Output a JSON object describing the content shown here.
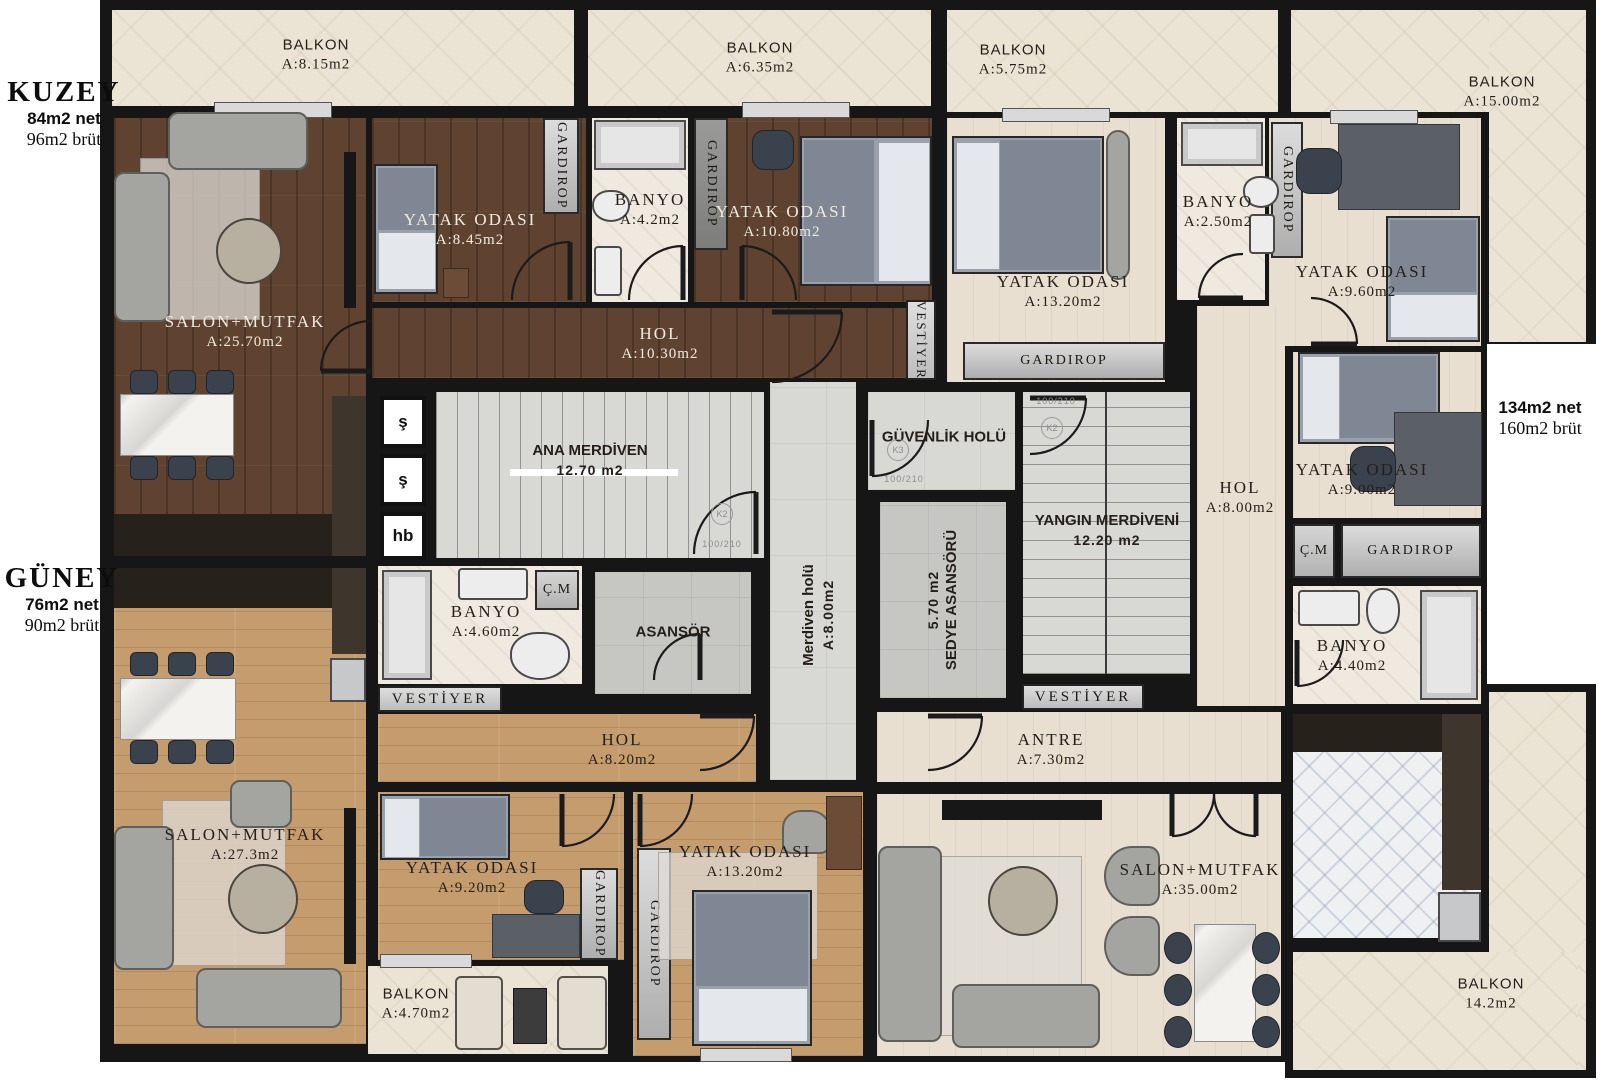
{
  "apartments": {
    "kuzey": {
      "title": "KUZEY",
      "net": "84m2 net",
      "brut": "96m2 brüt"
    },
    "guney": {
      "title": "GÜNEY",
      "net": "76m2 net",
      "brut": "90m2 brüt"
    },
    "daire3": {
      "net": "134m2 net",
      "brut": "160m2 brüt"
    }
  },
  "rooms": {
    "balkon815": {
      "name": "BALKON",
      "area": "A:8.15m2"
    },
    "balkon635": {
      "name": "BALKON",
      "area": "A:6.35m2"
    },
    "balkon575": {
      "name": "BALKON",
      "area": "A:5.75m2"
    },
    "balkon1500": {
      "name": "BALKON",
      "area": "A:15.00m2"
    },
    "balkon470": {
      "name": "BALKON",
      "area": "A:4.70m2"
    },
    "balkon142": {
      "name": "BALKON",
      "area": "14.2m2"
    },
    "kz_salon": {
      "name": "SALON+MUTFAK",
      "area": "A:25.70m2"
    },
    "kz_yatak1": {
      "name": "YATAK ODASI",
      "area": "A:8.45m2"
    },
    "kz_banyo": {
      "name": "BANYO",
      "area": "A:4.2m2"
    },
    "kz_yatak2": {
      "name": "YATAK ODASI",
      "area": "A:10.80m2"
    },
    "kz_hol": {
      "name": "HOL",
      "area": "A:10.30m2"
    },
    "rt_yatak1": {
      "name": "YATAK ODASI",
      "area": "A:13.20m2"
    },
    "rt_banyo1": {
      "name": "BANYO",
      "area": "A:2.50m2"
    },
    "rt_yatak2": {
      "name": "YATAK ODASI",
      "area": "A:9.60m2"
    },
    "rt_yatak3": {
      "name": "YATAK ODASI",
      "area": "A:9.00m2"
    },
    "rt_hol": {
      "name": "HOL",
      "area": "A:8.00m2"
    },
    "rt_banyo2": {
      "name": "BANYO",
      "area": "A:4.40m2"
    },
    "rt_antre": {
      "name": "ANTRE",
      "area": "A:7.30m2"
    },
    "rt_salon": {
      "name": "SALON+MUTFAK",
      "area": "A:35.00m2"
    },
    "gn_salon": {
      "name": "SALON+MUTFAK",
      "area": "A:27.3m2"
    },
    "gn_yatak1": {
      "name": "YATAK ODASI",
      "area": "A:9.20m2"
    },
    "gn_hol": {
      "name": "HOL",
      "area": "A:8.20m2"
    },
    "gn_yatak2": {
      "name": "YATAK ODASI",
      "area": "A:13.20m2"
    },
    "ana_merdiven": {
      "name": "ANA MERDİVEN",
      "area": "12.70 m2"
    },
    "core_banyo": {
      "name": "BANYO",
      "area": "A:4.60m2"
    },
    "asansor": {
      "name": "ASANSÖR"
    },
    "merdiven_holu": {
      "name": "Merdiven holü",
      "area": "A:8.00m2"
    },
    "guvenlik_holu": {
      "name": "GÜVENLİK HOLÜ"
    },
    "sedye": {
      "name": "SEDYE ASANSÖRÜ",
      "area": "5.70 m2"
    },
    "yangin": {
      "name": "YANGIN MERDİVENİ",
      "area": "12.20 m2"
    }
  },
  "fixtures": {
    "gardirop": "GARDIROP",
    "vestiyer": "VESTİYER",
    "cm": "Ç.M",
    "shaft1": "ş",
    "shaft2": "ş",
    "shaft3": "hb",
    "door_k2": "K2",
    "door_k3": "K3",
    "door_dim": "100/210"
  },
  "colors": {
    "wall": "#161616",
    "dark_wood": "#5f4330",
    "tan_wood": "#c59c6e",
    "pale_wood": "#e9dfd0",
    "marble": "#ebe3d4",
    "core_tile": "#d8d8d5",
    "bath_tile": "#efe9e0"
  }
}
